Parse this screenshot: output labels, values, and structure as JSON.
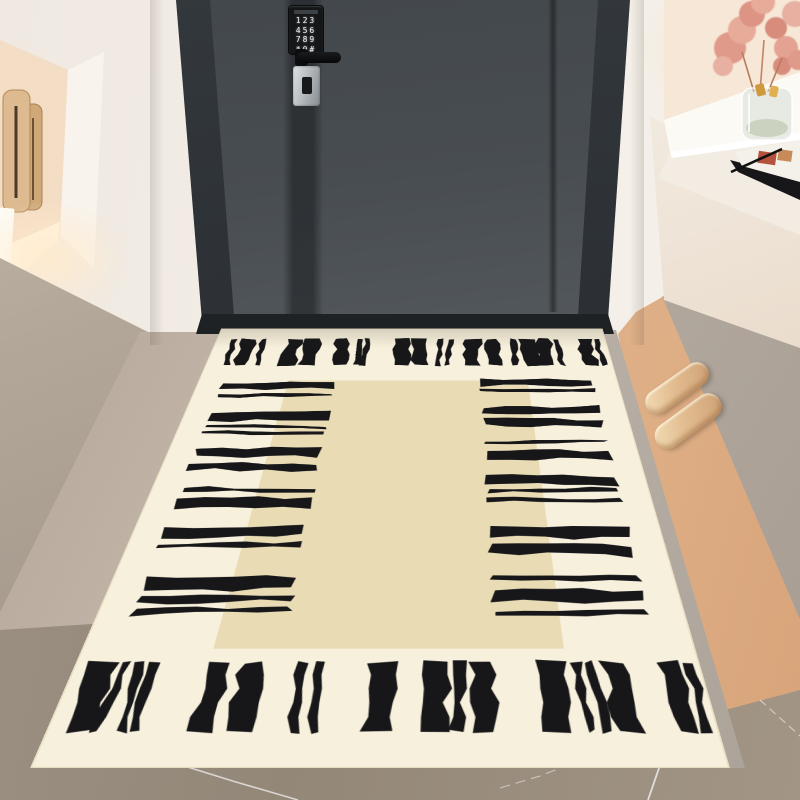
{
  "scene": {
    "caption": "Entryway with charcoal security door, keypad lock, beige brushstroke doormat, slippers and dried pink flowers"
  },
  "door": {
    "keypad_rows": [
      "123",
      "456",
      "789",
      "*0#"
    ],
    "leaf_color": "#474c50",
    "frame_color": "#2f3337"
  },
  "palette": {
    "wall": "#f2ede6",
    "cabinet_taupe": "#b3a799",
    "marble_floor": "#98публ8b78",
    "warm_strip": "#e2b58c",
    "slipper": "#e2bd91",
    "flower_pink": "#e29a8a",
    "mat_cream": "#f7f0dc",
    "mat_field": "#e9dcb4",
    "mat_ink": "#17171a"
  },
  "objects": {
    "slippers_count": 2,
    "hangers_count": 2,
    "vase": "glass cylinder with gold accents",
    "magazine": "open magazine with pen on counter"
  },
  "mat_pattern": {
    "plane": {
      "w": 700,
      "h": 1160
    },
    "base": "#f7f0dc",
    "field": "#e9dcb4",
    "ink": "#17171a",
    "field_rect": [
      150,
      228,
      400,
      736
    ],
    "top": {
      "y": 48,
      "len": 118,
      "strokes": [
        [
          28,
          10
        ],
        [
          46,
          24
        ],
        [
          80,
          9
        ],
        [
          128,
          26
        ],
        [
          162,
          26
        ],
        [
          215,
          24
        ],
        [
          252,
          9
        ],
        [
          268,
          9
        ],
        [
          320,
          26
        ],
        [
          354,
          26
        ],
        [
          400,
          9
        ],
        [
          416,
          9
        ],
        [
          448,
          26
        ],
        [
          482,
          24
        ],
        [
          530,
          9
        ],
        [
          546,
          24
        ],
        [
          576,
          24
        ],
        [
          606,
          9
        ],
        [
          648,
          24
        ],
        [
          678,
          8
        ]
      ]
    },
    "bottom": {
      "y": 988,
      "len": 118,
      "strokes": [
        [
          18,
          26
        ],
        [
          52,
          10
        ],
        [
          68,
          10
        ],
        [
          84,
          10
        ],
        [
          150,
          26
        ],
        [
          186,
          26
        ],
        [
          248,
          10
        ],
        [
          268,
          10
        ],
        [
          330,
          30
        ],
        [
          392,
          26
        ],
        [
          424,
          12
        ],
        [
          444,
          26
        ],
        [
          520,
          26
        ],
        [
          556,
          10
        ],
        [
          572,
          10
        ],
        [
          590,
          26
        ],
        [
          652,
          26
        ],
        [
          684,
          10
        ]
      ]
    },
    "left": {
      "x": 42,
      "len": 186,
      "strokes": [
        [
          240,
          26
        ],
        [
          282,
          12
        ],
        [
          352,
          28
        ],
        [
          392,
          10
        ],
        [
          414,
          10
        ],
        [
          472,
          26
        ],
        [
          516,
          22
        ],
        [
          590,
          12
        ],
        [
          620,
          28
        ],
        [
          700,
          24
        ],
        [
          740,
          10
        ],
        [
          820,
          28
        ],
        [
          862,
          12
        ],
        [
          886,
          12
        ]
      ]
    },
    "right": {
      "x": 472,
      "len": 184,
      "strokes": [
        [
          225,
          24
        ],
        [
          262,
          10
        ],
        [
          330,
          26
        ],
        [
          372,
          24
        ],
        [
          448,
          10
        ],
        [
          476,
          28
        ],
        [
          555,
          26
        ],
        [
          596,
          10
        ],
        [
          620,
          10
        ],
        [
          695,
          28
        ],
        [
          738,
          24
        ],
        [
          815,
          10
        ],
        [
          845,
          26
        ],
        [
          890,
          10
        ]
      ]
    }
  }
}
